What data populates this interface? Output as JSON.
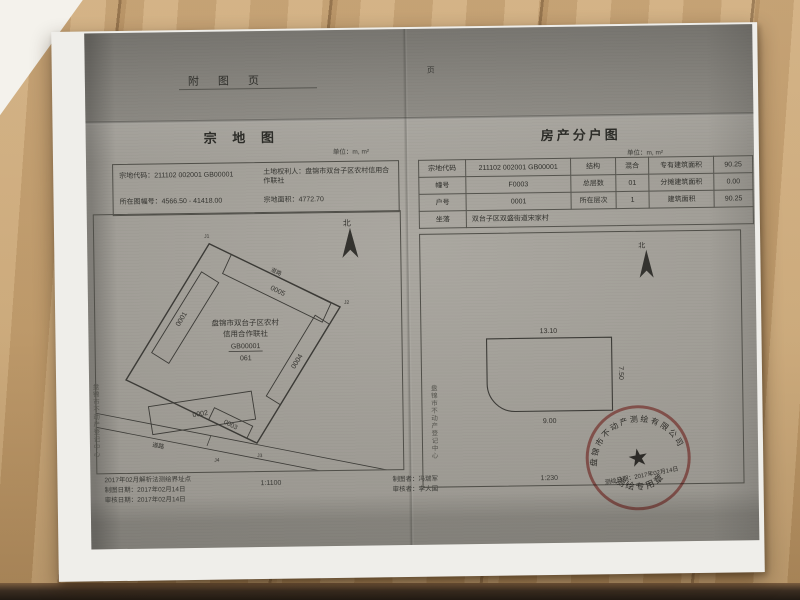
{
  "colors": {
    "stamp_red": "#b5443c",
    "scan_gray": "#9c9992",
    "desk_wood": "#c2a06e",
    "ink": "#3a3a36"
  },
  "header": {
    "title": "附 图 页",
    "page_mark": "页"
  },
  "left_page": {
    "title": "宗 地 图",
    "unit": "单位：m, m²",
    "info": {
      "parcel_code_label": "宗地代码：",
      "parcel_code": "211102 002001 GB00001",
      "owner_label": "土地权利人：",
      "owner": "盘锦市双台子区农村信用合作联社",
      "sheet_label": "所在图幅号：",
      "sheet_no": "4566.50 - 41418.00",
      "area_label": "宗地面积：",
      "area": "4772.70"
    },
    "map": {
      "north": "北",
      "owner_lines": [
        "盘锦市双台子区农村",
        "信用合作联社",
        "GB00001",
        "061"
      ],
      "buildings": [
        "0001",
        "0002",
        "0003",
        "0004",
        "0005"
      ],
      "road": "道路",
      "points": [
        "J1",
        "J2",
        "J3",
        "J4"
      ]
    },
    "footer": {
      "note": "2017年02月解析法测绘界址点",
      "draw_date": "制图日期：2017年02月14日",
      "review_date": "审核日期：2017年02月14日",
      "scale": "1:1100",
      "drafter": "制图者：冯瑞军",
      "reviewer": "审核者：李大国"
    },
    "side_text": "盘锦市不动产登记中心"
  },
  "right_page": {
    "title": "房产分户图",
    "unit": "单位：m, m²",
    "table": {
      "rows": [
        [
          "宗地代码",
          "211102 002001 GB00001",
          "结构",
          "混合",
          "专有建筑面积",
          "90.25"
        ],
        [
          "幢号",
          "F0003",
          "总层数",
          "01",
          "分摊建筑面积",
          "0.00"
        ],
        [
          "户号",
          "0001",
          "所在层次",
          "1",
          "建筑面积",
          "90.25"
        ]
      ],
      "last_row": {
        "label": "坐落",
        "value": "双台子区双盛街道宋家村"
      }
    },
    "drawing": {
      "north": "北",
      "dim_top": "13.10",
      "dim_right": "7.50",
      "dim_bottom": "9.00",
      "scale": "1:230"
    },
    "side_text": "盘锦市不动产登记中心",
    "stamp": {
      "arc_text": "盘锦市不动产测绘有限公司",
      "star_glyph": "★",
      "date": "测绘日期：2017年02月14日",
      "bottom_text": "测绘专用章"
    }
  }
}
